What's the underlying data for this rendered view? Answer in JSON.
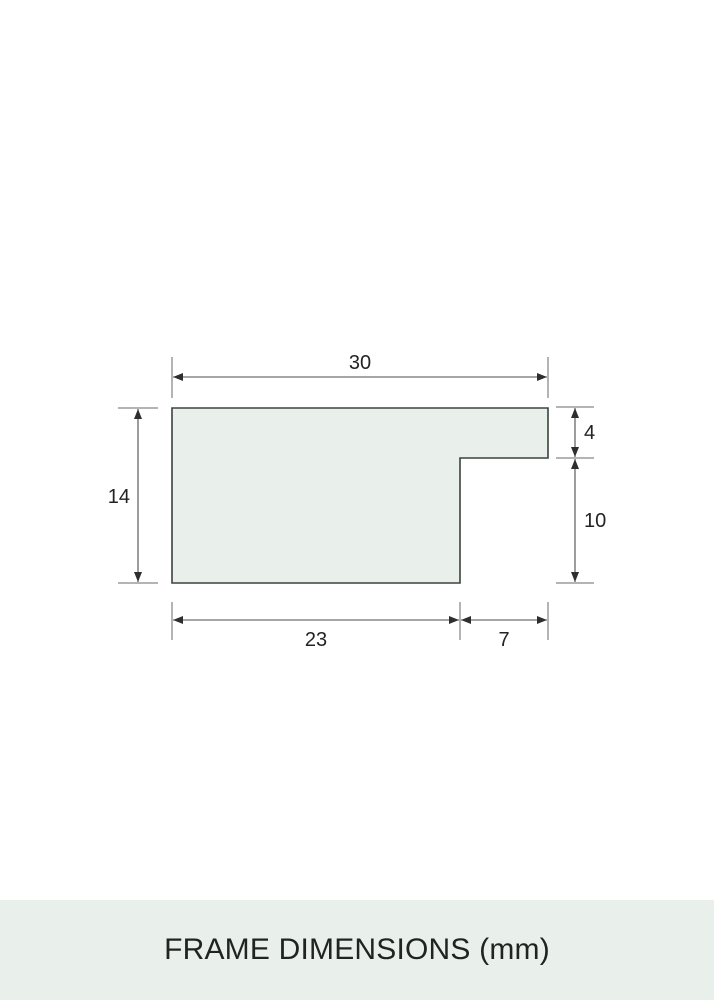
{
  "colors": {
    "background": "#ffffff",
    "surface": "#e9efeb",
    "outline": "#3d423d",
    "dimension_line": "#4d4d4d",
    "label_text": "#232323",
    "title_text": "#1f241f"
  },
  "diagram": {
    "unit": "mm",
    "labels": {
      "top_width": "30",
      "left_height": "14",
      "right_upper": "4",
      "right_lower": "10",
      "bottom_left": "23",
      "bottom_right": "7"
    }
  },
  "footer": {
    "title": "FRAME DIMENSIONS (mm)"
  }
}
